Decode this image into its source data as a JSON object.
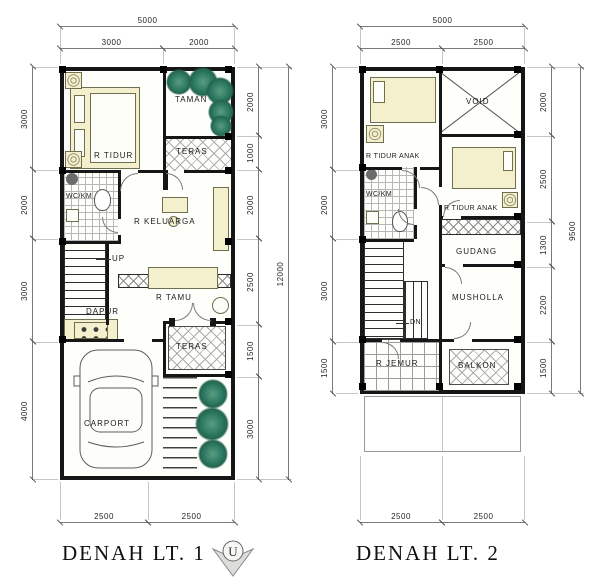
{
  "plan1": {
    "title": "DENAH LT. 1",
    "dim_top_total": "5000",
    "dim_top": [
      "3000",
      "2000"
    ],
    "dim_left": [
      "3000",
      "2000",
      "3000",
      "4000"
    ],
    "dim_right": [
      "2000",
      "1000",
      "2000",
      "2500",
      "1500",
      "3000"
    ],
    "dim_right_total": "12000",
    "dim_bottom": [
      "2500",
      "2500"
    ],
    "rooms": {
      "r_tidur": "R TIDUR",
      "taman": "TAMAN",
      "teras_atas": "TERAS",
      "wc_km": "WC/KM",
      "r_keluarga": "R KELUARGA",
      "up": "UP",
      "dapur": "DAPUR",
      "r_tamu": "R TAMU",
      "teras_bawah": "TERAS",
      "carport": "CARPORT"
    }
  },
  "plan2": {
    "title": "DENAH LT. 2",
    "dim_top_total": "5000",
    "dim_top": [
      "2500",
      "2500"
    ],
    "dim_left": [
      "3000",
      "2000",
      "3000",
      "1500"
    ],
    "dim_right": [
      "2000",
      "2500",
      "1300",
      "2200",
      "1500"
    ],
    "dim_right_total": "9500",
    "dim_bottom": [
      "2500",
      "2500"
    ],
    "rooms": {
      "r_tidur_anak1": "R TIDUR ANAK",
      "void": "VOID",
      "wc_km": "WC/KM",
      "r_tidur_anak2": "R TIDUR ANAK",
      "gudang": "GUDANG",
      "musholla": "MUSHOLLA",
      "dn": "DN",
      "r_jemur": "R JEMUR",
      "balkon": "BALKON"
    }
  },
  "compass": {
    "north_label": "U"
  },
  "colors": {
    "wall": "#161616",
    "furniture": "#f4efcd",
    "plant": "#2e7b63",
    "dim_line": "#7a7a7a"
  }
}
